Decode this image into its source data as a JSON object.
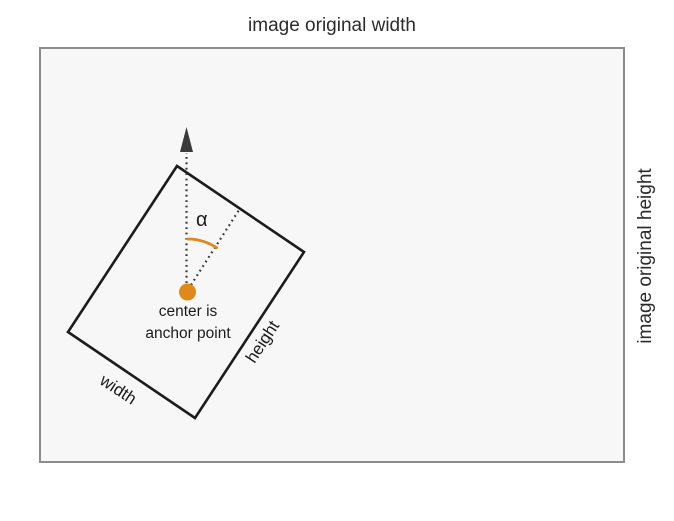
{
  "outer_box": {
    "top_label": "image original width",
    "right_label": "image original height"
  },
  "rotated_rect": {
    "width_label": "width",
    "height_label": "height"
  },
  "center_annotation": {
    "line1": "center is",
    "line2": "anchor point"
  },
  "angle": {
    "label": "α"
  },
  "colors": {
    "accent_orange": "#de891a",
    "line_dark": "#1c1c1c",
    "dotted_line": "#3a3a3a",
    "box_border": "#8c8c8c",
    "box_fill": "#f7f7f7",
    "text": "#2b2b2b"
  }
}
